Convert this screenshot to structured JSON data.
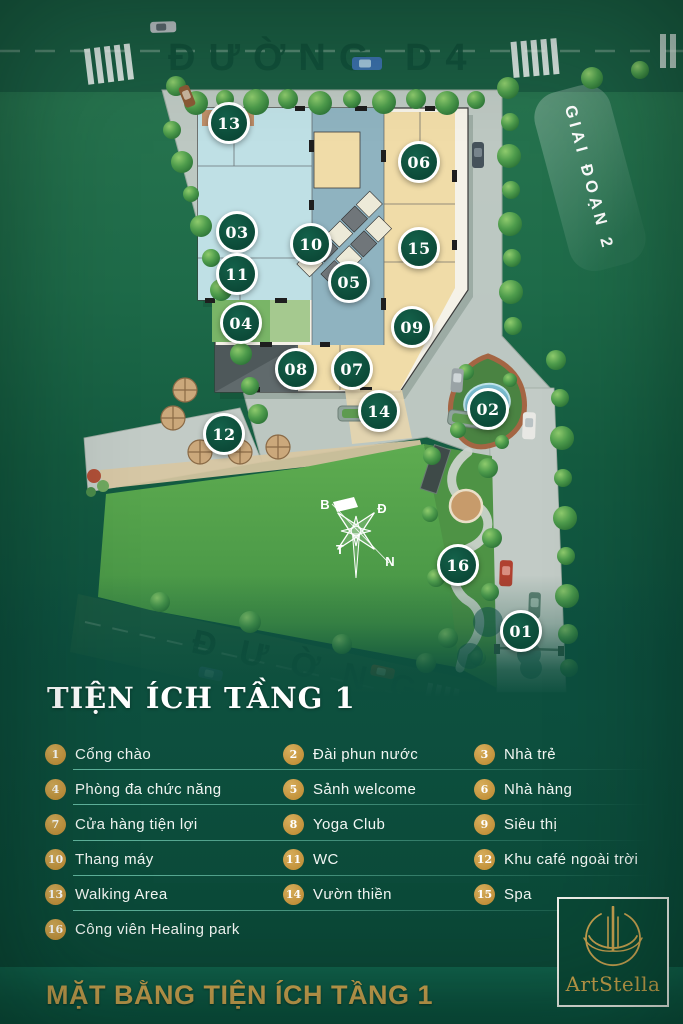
{
  "map": {
    "road_top_label": "ĐƯỜNG D4",
    "road_bottom_label": "ĐƯỜNG",
    "phase_label": "GIAI ĐOẠN 2",
    "compass": {
      "north": "B",
      "east": "Đ",
      "west": "T",
      "south": "N"
    },
    "markers": [
      {
        "num": "01"
      },
      {
        "num": "02"
      },
      {
        "num": "03"
      },
      {
        "num": "04"
      },
      {
        "num": "05"
      },
      {
        "num": "06"
      },
      {
        "num": "07"
      },
      {
        "num": "08"
      },
      {
        "num": "09"
      },
      {
        "num": "10"
      },
      {
        "num": "11"
      },
      {
        "num": "12"
      },
      {
        "num": "13"
      },
      {
        "num": "14"
      },
      {
        "num": "15"
      },
      {
        "num": "16"
      }
    ]
  },
  "legend": {
    "title": "TIỆN ÍCH TẦNG 1",
    "items": [
      {
        "num": "1",
        "label": "Cổng chào"
      },
      {
        "num": "2",
        "label": "Đài phun nước"
      },
      {
        "num": "3",
        "label": "Nhà trẻ"
      },
      {
        "num": "4",
        "label": "Phòng đa chức năng"
      },
      {
        "num": "5",
        "label": "Sảnh welcome"
      },
      {
        "num": "6",
        "label": "Nhà hàng"
      },
      {
        "num": "7",
        "label": "Cửa hàng tiện lợi"
      },
      {
        "num": "8",
        "label": "Yoga Club"
      },
      {
        "num": "9",
        "label": "Siêu thị"
      },
      {
        "num": "10",
        "label": "Thang máy"
      },
      {
        "num": "11",
        "label": "WC"
      },
      {
        "num": "12",
        "label": "Khu café ngoài trời"
      },
      {
        "num": "13",
        "label": "Walking Area"
      },
      {
        "num": "14",
        "label": "Vườn thiền"
      },
      {
        "num": "15",
        "label": "Spa"
      },
      {
        "num": "16",
        "label": "Công viên Healing park"
      }
    ]
  },
  "footer": {
    "title": "MẶT BẰNG TIỆN ÍCH TẦNG 1",
    "brand": "ArtStella"
  },
  "colors": {
    "accent_gold": "#C9A24B",
    "marker_green": "#0C4A38",
    "divider_teal": "#4FB39A",
    "pavement_gray": "#C2CBC6",
    "lawn_green": "#5CA94F"
  }
}
